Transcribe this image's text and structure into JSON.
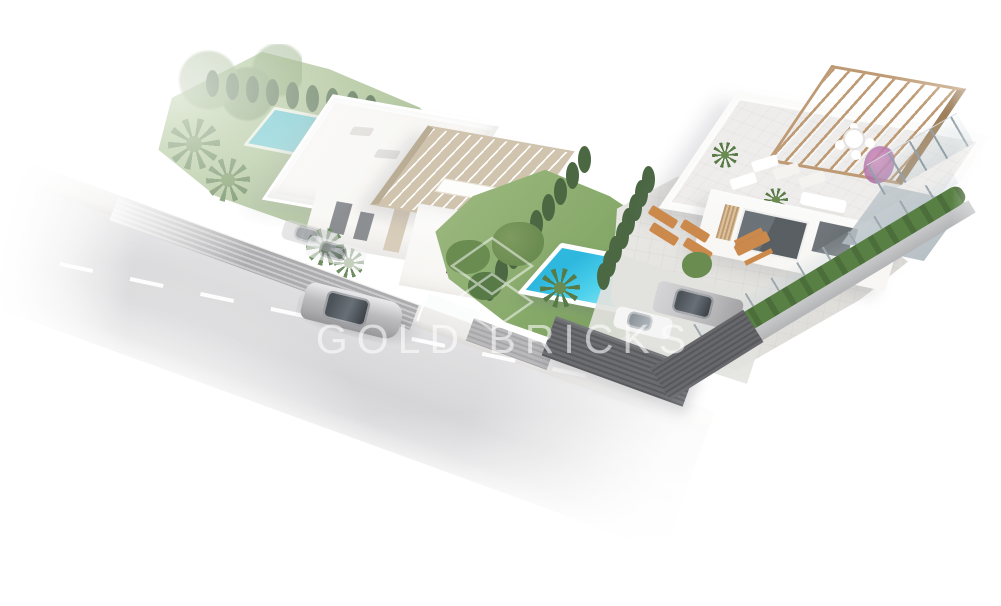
{
  "meta": {
    "width": 1001,
    "height": 606,
    "type": "aerial isometric 3D architectural render"
  },
  "watermark": {
    "text": "GOLD BRICKS",
    "logo": "double-diamond-outline",
    "color": "#ffffff"
  },
  "palette": {
    "canvas": "#ffffff",
    "lawn": "#7ca25d",
    "lawn-light": "#93b274",
    "lawn-faded": "#aabf97",
    "cypress": "#3d5c35",
    "shrub": "#5f8344",
    "hedge": "#4c7636",
    "palm": "#4a7038",
    "pool-deep": "#1fb3dc",
    "pool-light": "#7fe2f3",
    "pool-deck": "#ffffff",
    "wall": "#f7f6f3",
    "wall-shade": "#e6e4e0",
    "beige": "#cec0a9",
    "beige-dark": "#b5a78e",
    "wood": "#b9936a",
    "wood-dark": "#97764f",
    "terrace": "#edecea",
    "paving": "#e0dfdb",
    "road": "#d6d6d8",
    "sidewalk": "#eae8e5",
    "fence-light": "#a6a6a8",
    "fence-dark": "#595a5e",
    "glass-dark": "#4c5357",
    "car-silver": "#b7b7b9",
    "car-glass": "#3f464c",
    "car-white": "#f4f4f4",
    "lounger": "#c8803f",
    "bougainvillea": "#c77fb4"
  },
  "scene": {
    "description": "Aerial 3D render of a corner plot with two modern white villas, private pools, landscaped gardens and a street with a passing silver sedan; image fades to white at the edges",
    "objects": [
      {
        "name": "left-villa",
        "label": "white villa with flat roof terrace, garden pool and driveway (faded)"
      },
      {
        "name": "middle-villa",
        "label": "villa with beige slatted pergola roof"
      },
      {
        "name": "central-pool",
        "label": "turquoise rectangular pool with white deck and corner steps"
      },
      {
        "name": "right-villa",
        "label": "large villa with rooftop terrace and wooden pergola"
      },
      {
        "name": "courtyard",
        "label": "paved courtyard with orange sun loungers and picnic table"
      },
      {
        "name": "parked-cars",
        "label": "silver coupe and white car behind dark fence"
      },
      {
        "name": "road",
        "label": "asphalt street with dashed white center line and sidewalk"
      },
      {
        "name": "driving-car",
        "label": "silver sedan driving on the road"
      },
      {
        "name": "vegetation",
        "label": "cypress rows, palm trees, shrubs and right boundary hedge"
      },
      {
        "name": "watermark",
        "label": "GOLD BRICKS logo watermark"
      }
    ]
  }
}
